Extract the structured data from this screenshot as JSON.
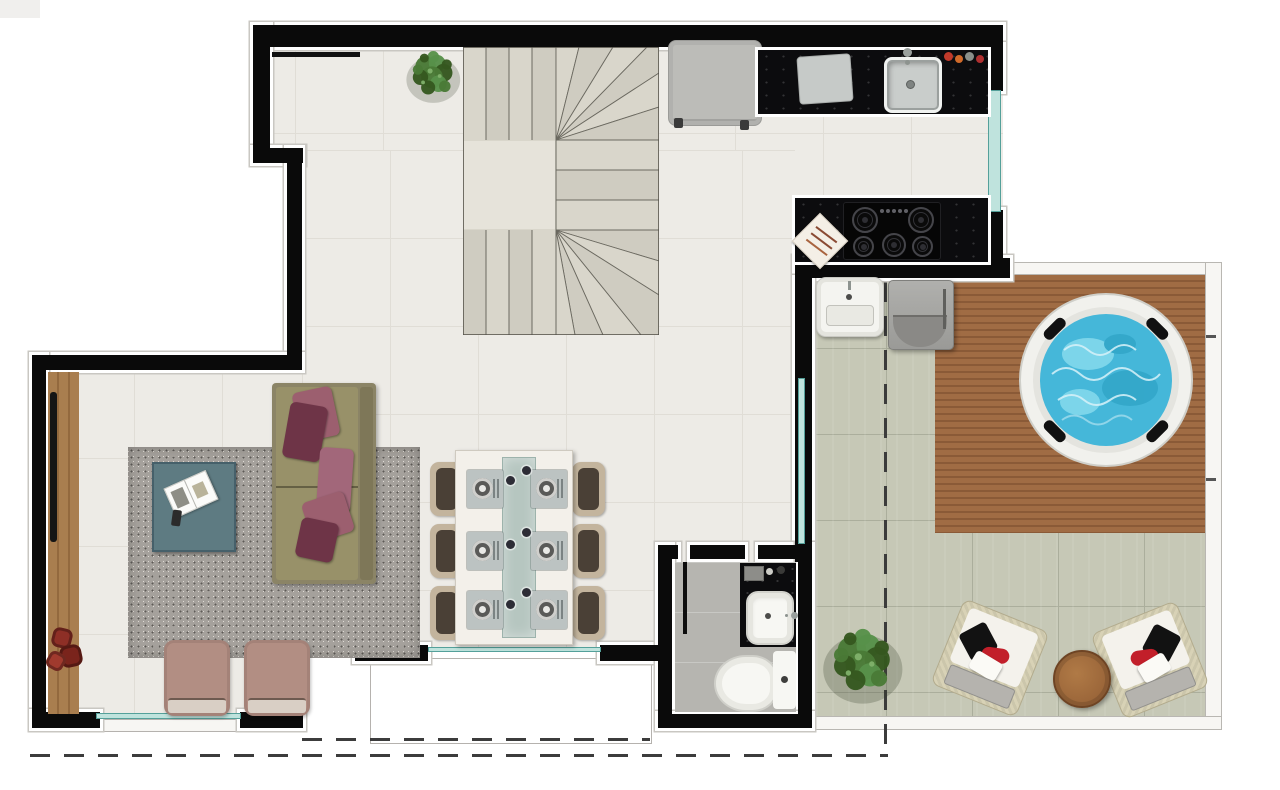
{
  "plan": {
    "view": "top-down apartment floor plan",
    "rooms": [
      "staircase-hall",
      "kitchen",
      "living-room",
      "dining-area",
      "bathroom",
      "laundry-nook",
      "terrace",
      "jacuzzi-deck",
      "balcony"
    ],
    "counts": {
      "dining_seats": 6,
      "place_settings": 6,
      "cooktop_burners": 5,
      "jacuzzi_headrests": 4,
      "floor_cushions": 3,
      "lounge_chairs": 2,
      "armchairs": 2
    },
    "furniture": {
      "kitchen": [
        "refrigerator",
        "black-granite-countertop",
        "cutting-board",
        "stainless-sink",
        "faucet",
        "condiment-set",
        "island-counter",
        "gas-cooktop",
        "kitchen-towel",
        "window"
      ],
      "living_room": [
        "wood-sideboard",
        "tv",
        "shag-rug",
        "coffee-table",
        "open-magazine",
        "remote-control",
        "sofa",
        "throw-pillows",
        "armchairs",
        "floor-cushions",
        "window"
      ],
      "dining_area": [
        "dining-table",
        "glass-runner",
        "place-settings",
        "upholstered-chairs"
      ],
      "staircase": [
        "u-shaped-winder-staircase",
        "potted-plant"
      ],
      "bathroom": [
        "shower-partition",
        "vanity-counter",
        "vessel-sink",
        "faucet",
        "toiletries",
        "toilet"
      ],
      "terrace": [
        "utility-sink",
        "washing-machine",
        "wood-deck",
        "round-jacuzzi",
        "potted-plant",
        "lounge-chairs",
        "round-side-table",
        "setback-dashed-boundary"
      ]
    }
  },
  "palette": {
    "wall": "#0a0a0a",
    "outline": "#ffffff",
    "outline_edge": "#c9c7c2",
    "floor": "#edebe6",
    "floor_line": "#e0ddd6",
    "terrace": "#c6c8b6",
    "terrace_line": "#abae9c",
    "deck_a": "#a06c44",
    "deck_b": "#8a5a37",
    "marble": "#f7f6f3",
    "water": "#45b7d9",
    "water_light": "#8fdff0",
    "water_deep": "#2fa3c6",
    "tub_rim": "#f1f1ed",
    "glass": "#bfe3dd",
    "glass_line": "#54a09a",
    "counter": "#0c0c0e",
    "steel": "#cfd3d1",
    "fridge": "#bcbcb8",
    "rug": "#a5a19c",
    "rug_dot_dark": "#5f5c58",
    "rug_dot_light": "#dedad4",
    "sofa": "#8b8466",
    "sofa_seat": "#989169",
    "sofa_back": "#7e7758",
    "pillow_rose": "#9c5f6f",
    "pillow_dark": "#6e3447",
    "teal_table": "#5e7b82",
    "wood_strip": "#a97e4f",
    "wood_strip_dark": "#93693e",
    "armchair": "#b28e83",
    "armchair_front": "#d9cfc5",
    "chair_tan": "#c3b49d",
    "chair_dark": "#4a4036",
    "table_white": "#f3f0ea",
    "runner": "#b6c6c0",
    "mat": "#bcc3c2",
    "plate": "#e9e9e6",
    "bath_floor": "#b6b5b0",
    "fixture": "#f7f7f3",
    "washer": "#a5a5a1",
    "rattan": "#d8d2b6",
    "lounge_white": "#f4f2ec",
    "lounge_black": "#121212",
    "lounge_red": "#c21f2a",
    "side_table": "#9a6539",
    "plant_a": "#4a7a36",
    "plant_b": "#35571f",
    "plant_c": "#57914a",
    "pouf": "#8e2f26",
    "dash": "#3c3c3c",
    "stair_a": "#d9d6cb",
    "stair_b": "#cfccc1",
    "stair_line": "#6b6960",
    "stair_border": "#55534b",
    "landing": "#e6e3da"
  }
}
